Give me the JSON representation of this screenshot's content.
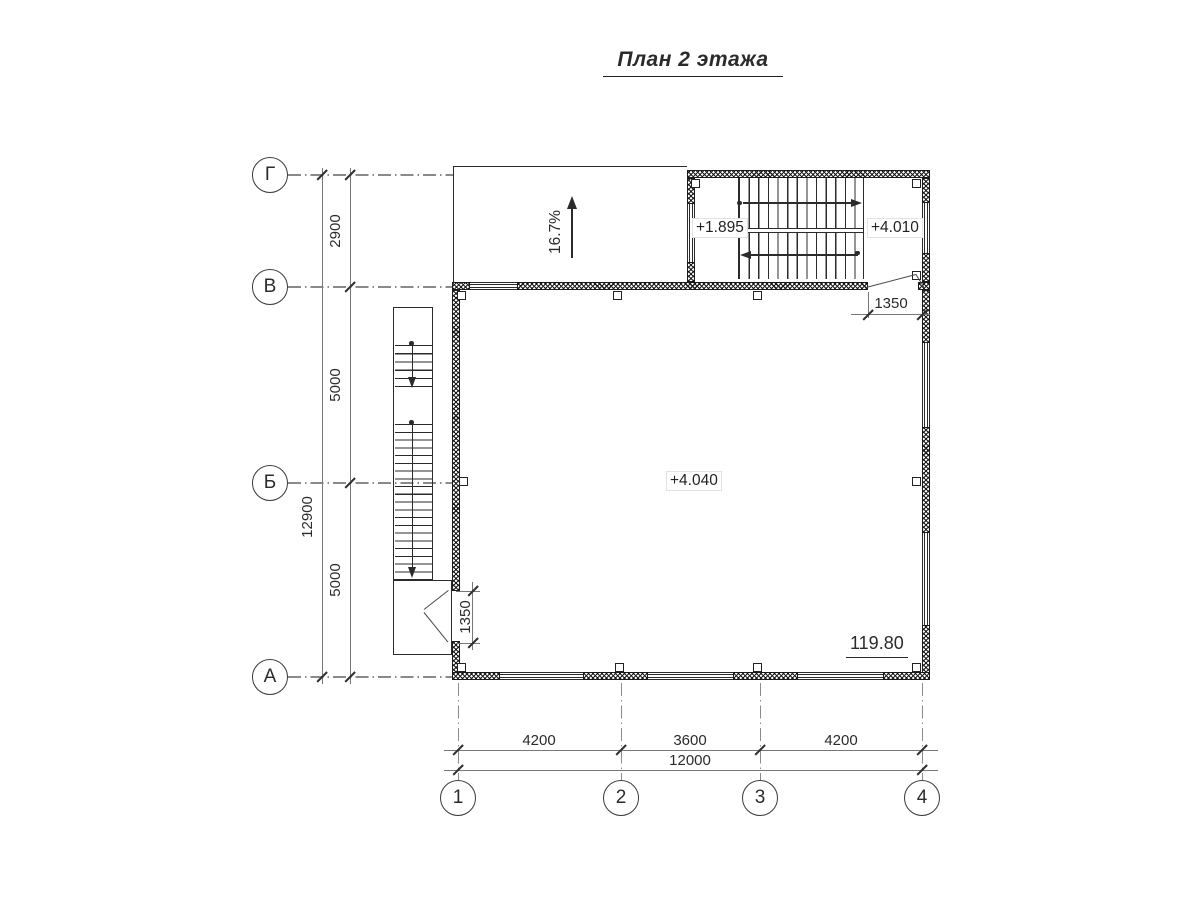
{
  "title": "План 2 этажа",
  "axes": {
    "rows": [
      {
        "label": "Г"
      },
      {
        "label": "В"
      },
      {
        "label": "Б"
      },
      {
        "label": "А"
      }
    ],
    "cols": [
      {
        "label": "1"
      },
      {
        "label": "2"
      },
      {
        "label": "3"
      },
      {
        "label": "4"
      }
    ]
  },
  "dims": {
    "left": {
      "segments": [
        "2900",
        "5000",
        "5000"
      ],
      "total": "12900"
    },
    "bottom": {
      "segments": [
        "4200",
        "3600",
        "4200"
      ],
      "total": "12000"
    },
    "stair_door": "1350",
    "side_door": "1350"
  },
  "levels": {
    "landing_mid": "+1.895",
    "landing_top": "+4.010",
    "floor": "+4.040"
  },
  "elevation_mark": "119.80",
  "ramp": {
    "slope": "16.7%"
  },
  "colors": {
    "line": "#2b2b2b",
    "dim_line": "#777777",
    "wall_hatch": "#1a1a1a",
    "background": "#ffffff"
  }
}
